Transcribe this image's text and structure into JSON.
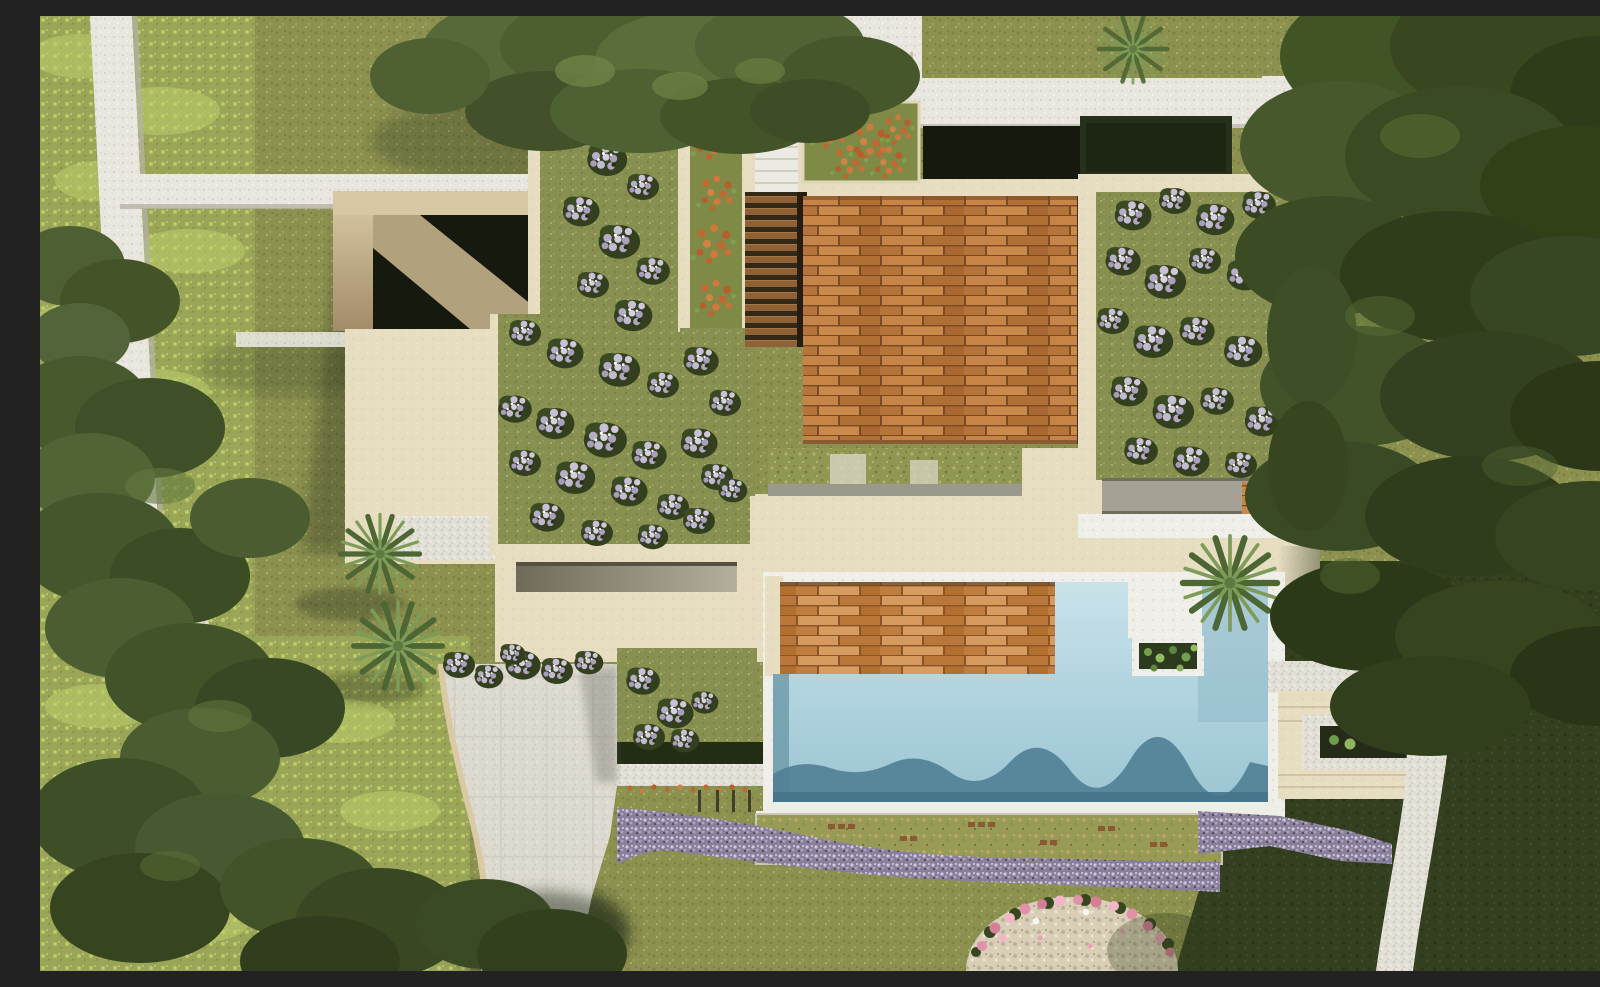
{
  "scene": {
    "title": "Aerial top-down 3D rendering of a modern villa with pool, timber decks, green roofs and gardens",
    "type": "architectural-render",
    "view": "top-down",
    "elements": [
      {
        "name": "lawn",
        "desc": "olive green grass covering the site"
      },
      {
        "name": "meadow",
        "desc": "lighter wild meadow strip on the left"
      },
      {
        "name": "tree-canopies",
        "desc": "dense pine canopies on left, top-left and right"
      },
      {
        "name": "stone-walls",
        "desc": "white dry-stone walls and paths, top-left and top-right"
      },
      {
        "name": "entry-court",
        "desc": "beige walled sunken court, left of house"
      },
      {
        "name": "sunken-patio",
        "desc": "dark sunken patio at top of house"
      },
      {
        "name": "hedge-court",
        "desc": "dark hedge inside white wall enclosure, top-right"
      },
      {
        "name": "green-roof-left",
        "desc": "green roof garden with lavender shrubs"
      },
      {
        "name": "green-roof-right",
        "desc": "green roof wing with lavender shrubs"
      },
      {
        "name": "orange-planters",
        "desc": "planters with orange flowers near entry stairs"
      },
      {
        "name": "timber-deck-upper",
        "desc": "large hardwood deck terrace"
      },
      {
        "name": "timber-deck-lower",
        "desc": "hardwood sun deck beside pool"
      },
      {
        "name": "pool",
        "desc": "L-shaped swimming pool with wave shadow band"
      },
      {
        "name": "pool-planter",
        "desc": "white step and green planter in pool"
      },
      {
        "name": "driveway",
        "desc": "curved paved driveway"
      },
      {
        "name": "long-bench",
        "desc": "linear stone bench water feature"
      },
      {
        "name": "wild-garden",
        "desc": "dry grass garden strip below pool"
      },
      {
        "name": "lavender-bands",
        "desc": "ribbons of lavender flowers"
      },
      {
        "name": "pink-mound",
        "desc": "stone mound ringed with pink flowers, bottom center"
      },
      {
        "name": "palms",
        "desc": "palm trees by driveway and pool"
      },
      {
        "name": "stone-path-right",
        "desc": "curving stone footpath on the right"
      },
      {
        "name": "steps-terrace-right",
        "desc": "terraced steps and planter right of pool"
      }
    ]
  },
  "palette": {
    "lawn": "#8c9150",
    "lawn_shade": "#343f20",
    "meadow": "#9aa557",
    "roof_grass": "#879050",
    "stone": "#e8e6de",
    "stone_bright": "#efeee8",
    "cream": "#e7dec2",
    "beige_wall": "#d8c7a4",
    "curb": "#d9c9a4",
    "drive": "#dcd9cf",
    "wood_deck": "#bd7c3e",
    "wood_deck_light": "#c8874a",
    "pool_light": "#c9e2ea",
    "pool_mid": "#aed2de",
    "pool_deep": "#9cc5d2",
    "pool_shadow": "#507f96",
    "lavender": "#877f9c",
    "lavender_light": "#cfc8db",
    "orange_flowers": "#c06a33",
    "pink_flowers": "#e292a8",
    "pebble": "#d9cfb8",
    "wild_garden": "#989b55",
    "hedge_dark": "#232d15",
    "pit_dark": "#15190e",
    "tree_mid": "#46582c",
    "tree_dark": "#324018",
    "palm_leaf": "#7e9c58"
  }
}
